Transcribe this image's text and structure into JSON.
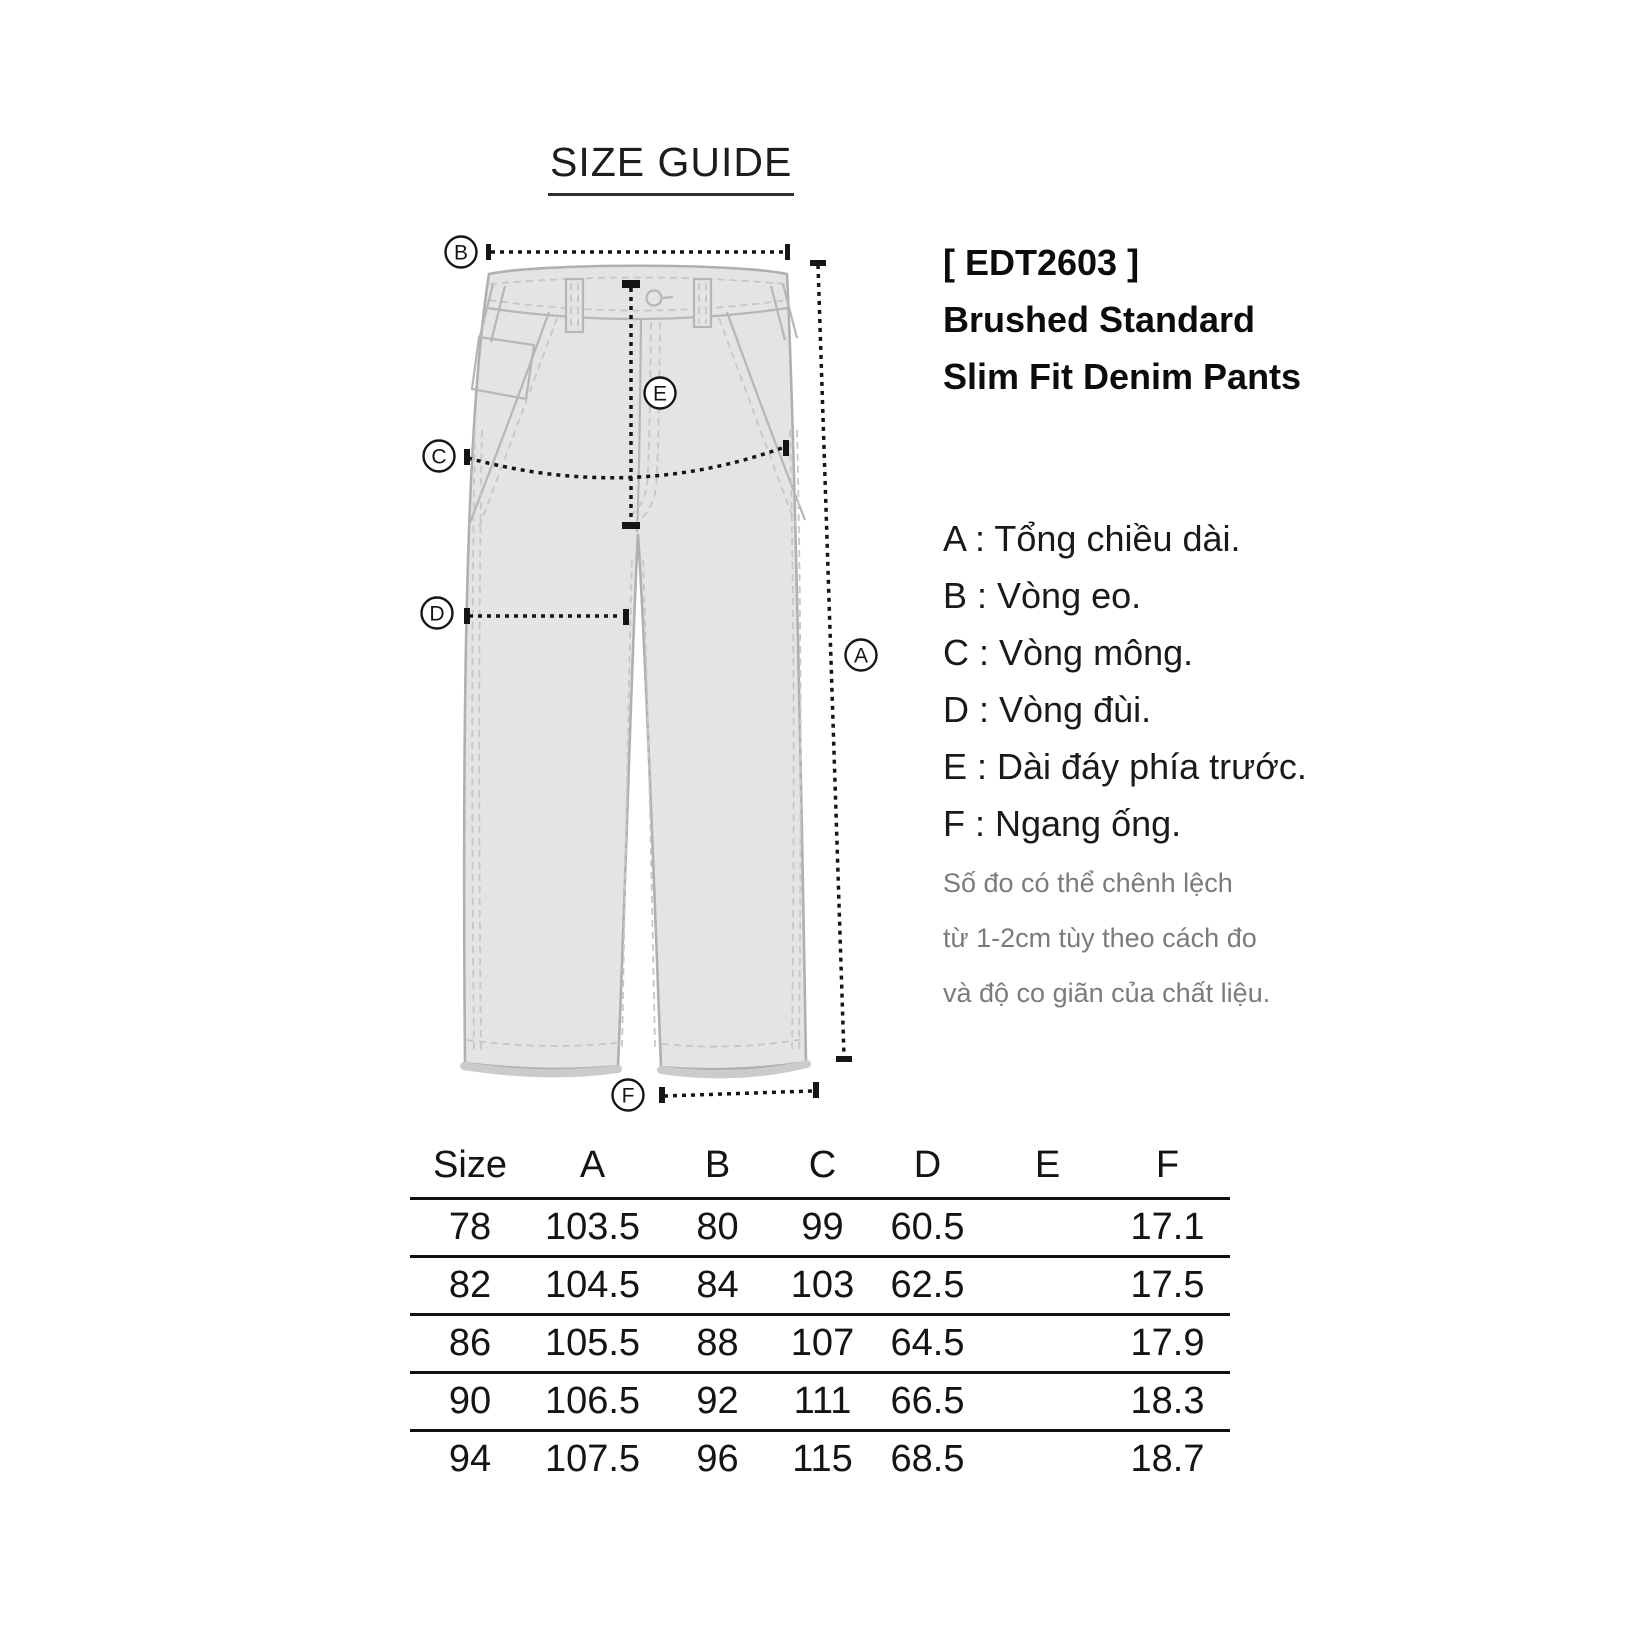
{
  "header": {
    "title": "SIZE GUIDE"
  },
  "product": {
    "code": "[ EDT2603 ]",
    "name_line1": "Brushed Standard",
    "name_line2": "Slim Fit Denim Pants"
  },
  "legend": {
    "items": [
      "A : Tổng chiều dài.",
      "B : Vòng eo.",
      "C : Vòng mông.",
      "D : Vòng đùi.",
      "E : Dài đáy phía trước.",
      "F : Ngang ống."
    ]
  },
  "note": {
    "lines": [
      "Số đo có thể chênh lệch",
      "từ 1-2cm tùy theo cách đo",
      "và độ co giãn của chất liệu."
    ]
  },
  "diagram": {
    "markers": {
      "a": "A",
      "b": "B",
      "c": "C",
      "d": "D",
      "e": "E",
      "f": "F"
    }
  },
  "size_table": {
    "columns": [
      "Size",
      "A",
      "B",
      "C",
      "D",
      "E",
      "F"
    ],
    "rows": [
      [
        "78",
        "103.5",
        "80",
        "99",
        "60.5",
        "",
        "17.1"
      ],
      [
        "82",
        "104.5",
        "84",
        "103",
        "62.5",
        "",
        "17.5"
      ],
      [
        "86",
        "105.5",
        "88",
        "107",
        "64.5",
        "",
        "17.9"
      ],
      [
        "90",
        "106.5",
        "92",
        "111",
        "66.5",
        "",
        "18.3"
      ],
      [
        "94",
        "107.5",
        "96",
        "115",
        "68.5",
        "",
        "18.7"
      ]
    ]
  },
  "colors": {
    "text": "#1a1a1a",
    "note_text": "#7b7b7b",
    "pants_fill": "#e4e4e4",
    "pants_outline": "#b0b0b0",
    "measurement": "#151515"
  }
}
